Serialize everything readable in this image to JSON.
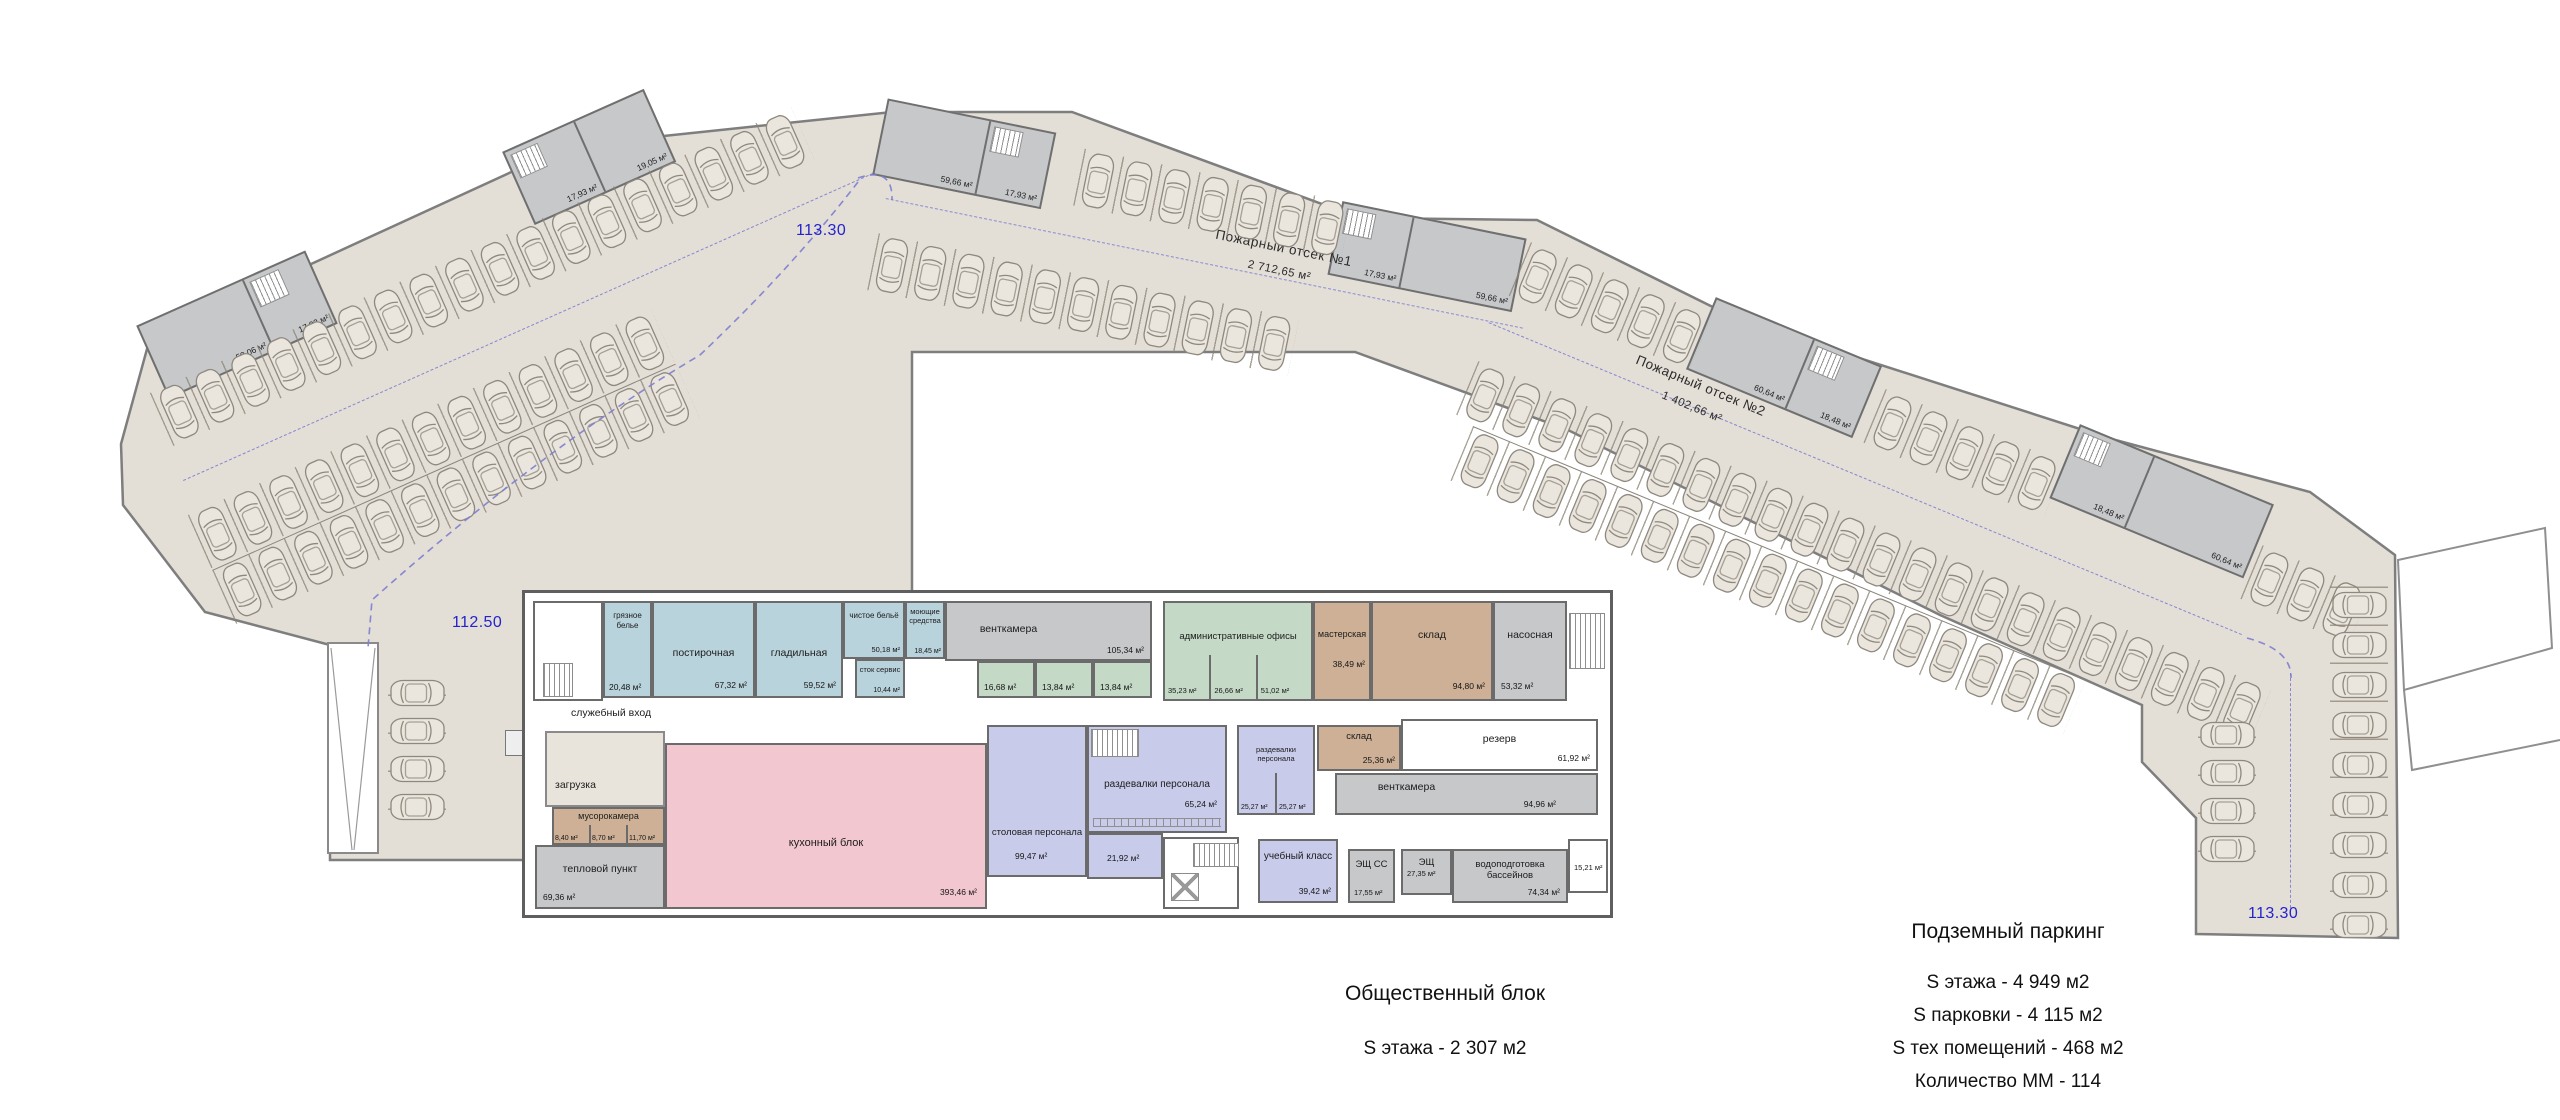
{
  "plan": {
    "elevation_top": "113.30",
    "elevation_left": "112.50",
    "elevation_bottom_right": "113.30",
    "fire1_name": "Пожарный отсек №1",
    "fire1_area": "2 712,65 м²",
    "fire2_name": "Пожарный отсек №2",
    "fire2_area": "1 402,66 м²",
    "service_entrance": "служебный вход"
  },
  "cores": {
    "a1a": "59,06 м²",
    "a1b": "17,93 м²",
    "a2a": "17,93 м²",
    "a2b": "19,05 м²",
    "b1a": "59,66 м²",
    "b1b": "17,93 м²",
    "b2a": "17,93 м²",
    "b2b": "59,66 м²",
    "c1a": "60,64 м²",
    "c1b": "18,48 м²",
    "c2a": "18,48 м²",
    "c2b": "60,64 м²"
  },
  "rooms": {
    "gryaznoe": {
      "label": "грязное белье",
      "area": "20,48 м²"
    },
    "postirochnaya": {
      "label": "постирочная",
      "area": "67,32 м²"
    },
    "gladilnaya": {
      "label": "гладильная",
      "area": "59,52 м²"
    },
    "chistoe": {
      "label": "чистое бельё",
      "area": "50,18 м²"
    },
    "stok": {
      "label": "сток сервис",
      "area": "10,44 м²"
    },
    "moyushchie": {
      "label": "моющие средства",
      "area": "18,45 м²"
    },
    "ventkamera1": {
      "label": "венткамера",
      "area": "105,34 м²"
    },
    "tech1": {
      "area": "16,68 м²"
    },
    "tech2": {
      "area": "13,84 м²"
    },
    "tech3": {
      "area": "13,84 м²"
    },
    "admin": {
      "label": "административные офисы",
      "areas": [
        "35,23 м²",
        "26,66 м²",
        "51,02 м²"
      ]
    },
    "masterskaya": {
      "label": "мастерская",
      "area": "38,49 м²"
    },
    "sklad1": {
      "label": "склад",
      "area": "94,80 м²"
    },
    "nasosnaya": {
      "label": "насосная",
      "area": "53,32 м²"
    },
    "zagruzka": {
      "label": "загрузка"
    },
    "musorokamera": {
      "label": "мусорокамера",
      "areas": [
        "8,40 м²",
        "8,70 м²",
        "11,70 м²"
      ]
    },
    "teplovoy": {
      "label": "тепловой пункт",
      "area": "69,36 м²"
    },
    "kuhonny": {
      "label": "кухонный блок",
      "area": "393,46 м²"
    },
    "stolovaya": {
      "label": "столовая персонала",
      "area": "99,47 м²"
    },
    "razdevalki1": {
      "label": "раздевалки персонала",
      "area": "65,24 м²"
    },
    "room2192": {
      "area": "21,92 м²"
    },
    "razdevalki2": {
      "label": "раздевалки персонала",
      "areas": [
        "25,27 м²",
        "25,27 м²"
      ]
    },
    "sklad2": {
      "label": "склад",
      "area": "25,36 м²"
    },
    "rezerv": {
      "label": "резерв",
      "area": "61,92 м²"
    },
    "ventkamera2": {
      "label": "венткамера",
      "area": "94,96 м²"
    },
    "ucheb": {
      "label": "учебный класс",
      "area": "39,42 м²"
    },
    "eshss": {
      "label": "ЭЩ СС",
      "area": "17,55 м²"
    },
    "esh": {
      "label": "ЭЩ",
      "area": "27,35 м²"
    },
    "vodopodgotovka": {
      "label": "водоподготовка бассейнов",
      "area": "74,34 м²"
    },
    "room1521": {
      "area": "15,21 м²"
    }
  },
  "legend_public": {
    "title": "Общественный блок",
    "area_line": "S этажа - 2 307 м2"
  },
  "legend_parking": {
    "title": "Подземный паркинг",
    "lines": [
      "S этажа - 4 949 м2",
      "S парковки - 4 115 м2",
      "S тех помещений - 468 м2",
      "Количество ММ - 114"
    ]
  },
  "colors": {
    "parking_fill": "#e3ded6",
    "wall": "#7a7a7a",
    "elevation_text": "#2424cf",
    "laundry": "#b9d3dd",
    "offices": "#c4dac6",
    "storage": "#cdb095",
    "tech": "#c6c8ca",
    "kitchen": "#f2c7cf",
    "staff": "#c8cbea"
  }
}
